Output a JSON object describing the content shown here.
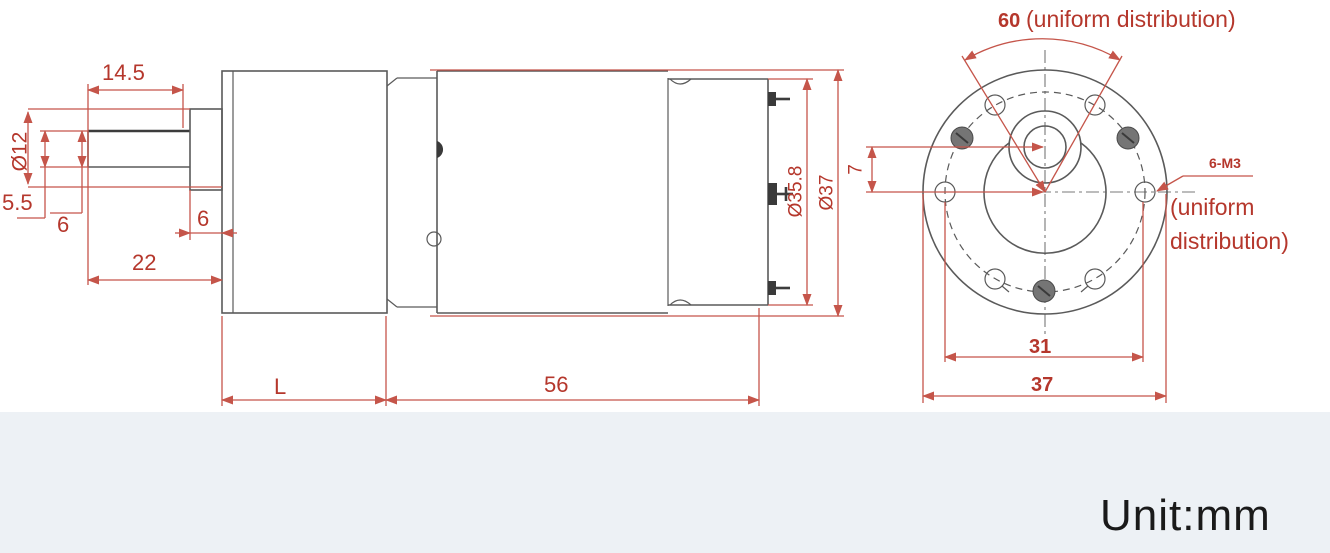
{
  "title": "Gear motor dimensional drawing",
  "unit_label": "Unit:mm",
  "colors": {
    "dimension_text": "#b5372c",
    "dimension_line": "#c5554a",
    "outline": "#5a5a5a",
    "background": "#ffffff",
    "footer_strip": "#edf1f5"
  },
  "side_view": {
    "shaft_flat_length": "14.5",
    "shaft_hub_diameter": "Ø12",
    "shaft_flat_width": "5.5",
    "shaft_diameter": "6",
    "hub_length": "6",
    "shaft_length": "22",
    "gearbox_length": "L",
    "motor_length": "56",
    "endcap_diameter": "Ø35.8",
    "body_diameter": "Ø37"
  },
  "end_view": {
    "hole_angle": "60",
    "hole_angle_note": "(uniform distribution)",
    "shaft_offset": "7",
    "screw_spec": "6-M3",
    "screw_note_line1": "(uniform",
    "screw_note_line2": "distribution)",
    "bolt_circle_diameter": "31",
    "flange_width": "37"
  }
}
